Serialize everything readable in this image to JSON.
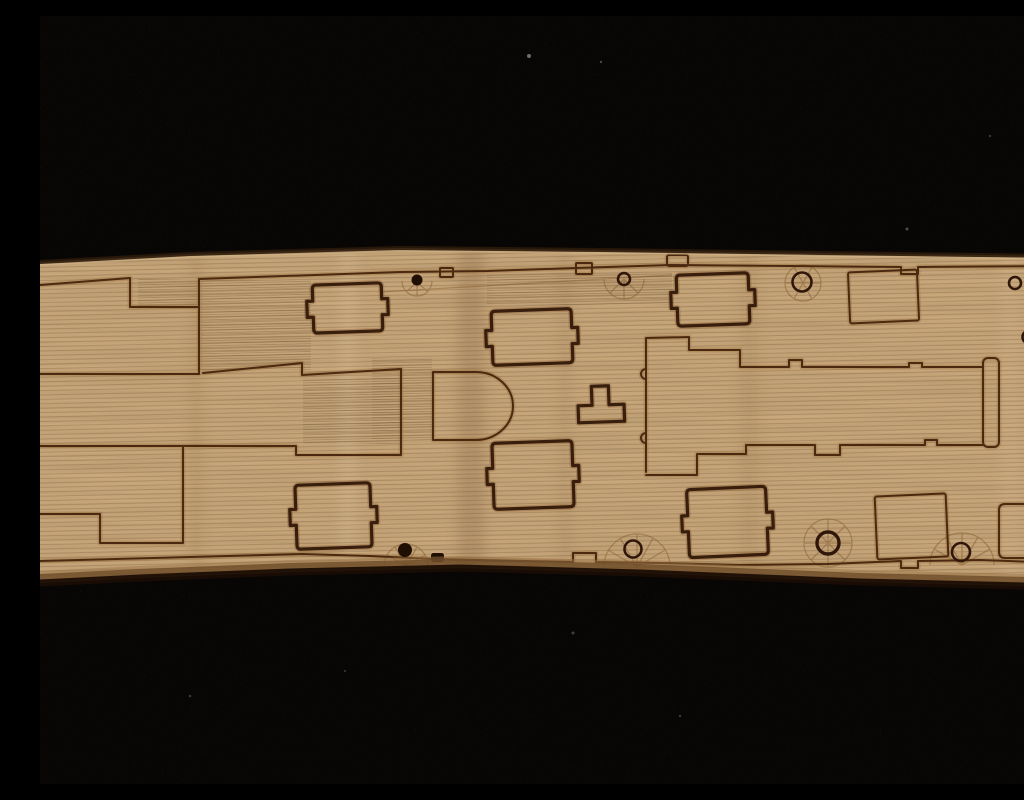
{
  "scene": {
    "domain": "natural photograph",
    "subject": "Close-up photo of a laser-etched wooden model ship deck sheet lying on black felt",
    "setting": "horizontal light-tan plywood strip crossing the whole frame, surrounded by near-black fabric above and below",
    "no_visible_text": true
  },
  "palette": {
    "background": "#080605",
    "wood_base": "#c9a87c",
    "plank_line": "#5d3f22",
    "etch_line": "#45240c",
    "hatch_line": "#33190a",
    "edge_dark": "#1a0d04",
    "edge_mid": "#6f4d29",
    "edge_light": "#9a7347",
    "speck": "#8a8578"
  },
  "wood_piece": {
    "material": "plywood deck sheet with laser-etched planking lines",
    "orientation_deg": -1.3,
    "features": {
      "deck_margin_lines": 2,
      "stepped_deck_breaks": 4,
      "notched_cargo_hatches": 6,
      "plain_square_hatches": 2,
      "ring_fittings": 9,
      "filled_dot_fittings": 2,
      "fan_etched_capstans": 7,
      "d_shaped_deckhouse": 1,
      "t_shaped_fitting": 1,
      "long_superstructure_channel": 1
    }
  }
}
